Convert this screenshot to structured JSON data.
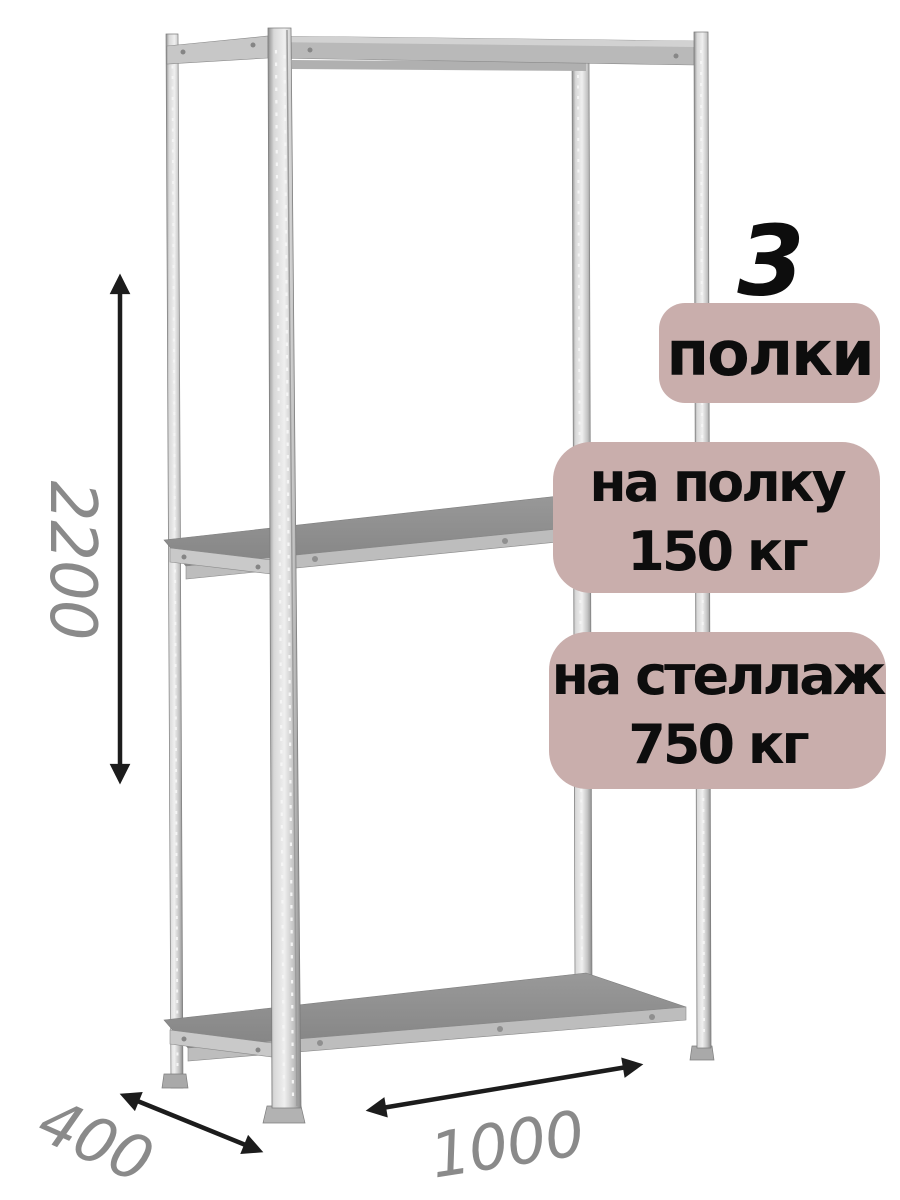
{
  "badges": {
    "count_number": "3",
    "count_label": "полки",
    "shelf_load": {
      "line1": "на полку",
      "line2": "150 кг"
    },
    "rack_load": {
      "line1": "на стеллаж",
      "line2": "750 кг"
    }
  },
  "dimensions": {
    "height": "2200",
    "depth": "400",
    "width": "1000"
  },
  "colors": {
    "badge_bg": "#c9aeac",
    "badge_text": "#0d0d0d",
    "dimension_text": "#8a8a8a",
    "arrow": "#1c1c1c",
    "metal_light": "#e8e8e8",
    "metal_mid": "#bdbdbd",
    "shelf_surface": "#8f8f8f"
  }
}
